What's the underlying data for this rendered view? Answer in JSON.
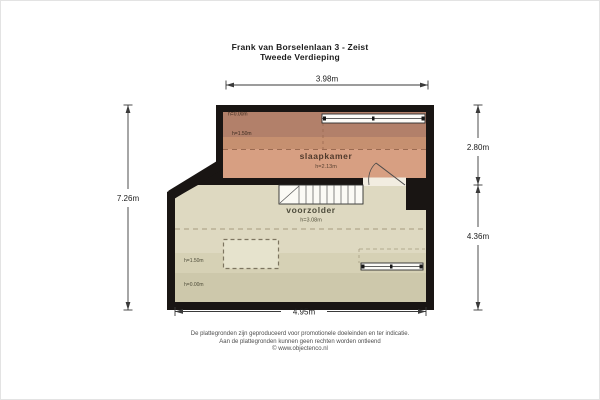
{
  "title": {
    "address": "Frank van Borselenlaan 3 - Zeist",
    "floor": "Tweede Verdieping"
  },
  "dimensions": {
    "top": "3.98m",
    "left": "7.26m",
    "right_upper": "2.80m",
    "right_lower": "4.36m",
    "bottom": "4.95m"
  },
  "rooms": {
    "slaapkamer": {
      "name": "slaapkamer",
      "ceiling_height": "h=2.13m",
      "contour_labels": [
        "h=0.00m",
        "h=1.50m"
      ],
      "floor_color": "#d79f82",
      "band_dark": "#b2806a",
      "band_mid": "#c69070"
    },
    "voorzolder": {
      "name": "voorzolder",
      "ceiling_height": "h=3.08m",
      "contour_labels": [
        "h=1.50m",
        "h=0.00m"
      ],
      "floor_color": "#ded9c1",
      "band_mid": "#d6d1b5",
      "band_dark": "#cdc8ab"
    }
  },
  "symbols": {
    "stairs": "staircase",
    "door": "door-swing",
    "roof_window": "roof-window",
    "radiator": "radiator",
    "chimney": "chimney-block",
    "floor_opening": "dashed-floor-opening"
  },
  "footer": {
    "line1": "De plattegronden zijn geproduceerd voor promotionele doeleinden en ter indicatie.",
    "line2": "Aan de plattegronden kunnen geen rechten worden ontleend",
    "line3": "© www.objectenco.nl"
  },
  "colors": {
    "wall": "#191513",
    "dimension_line": "#3a3a3a",
    "background": "#ffffff"
  }
}
